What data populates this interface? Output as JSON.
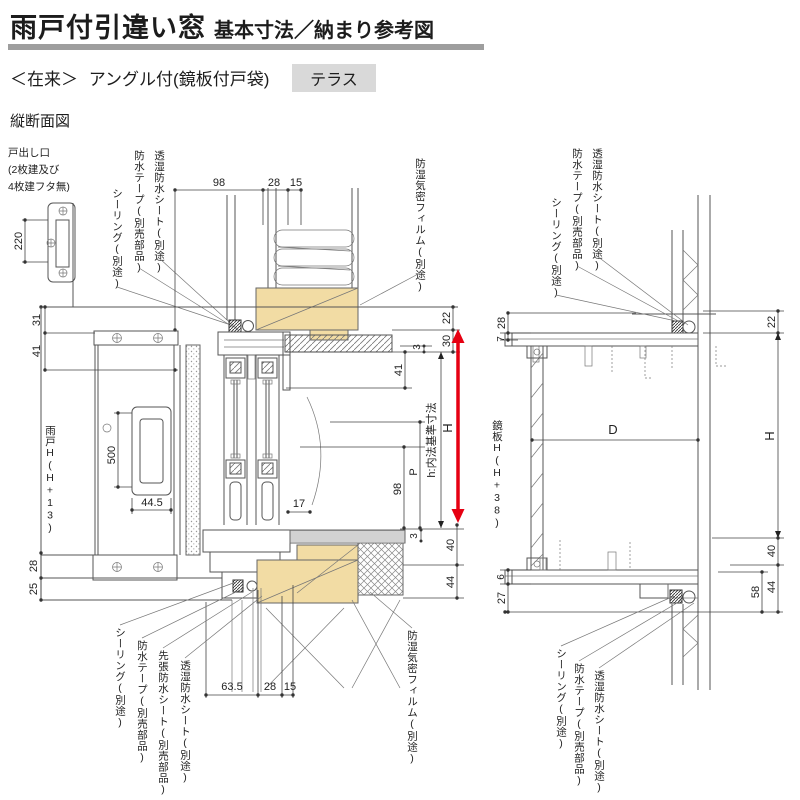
{
  "header": {
    "title_main": "雨戸付引違い窓",
    "title_sub": "基本寸法／納まり参考図",
    "tag_prefix": "＜在来＞",
    "tag_name": "アングル付(鏡板付戸袋)",
    "tag_badge": "テラス",
    "section": "縦断面図"
  },
  "note": {
    "l1": "戸出し口",
    "l2": "(2枚建及び",
    "l3": "4枚建フタ無)"
  },
  "labels": {
    "sealing": "シーリング(別途)",
    "tape": "防水テープ(別売部品)",
    "sheet": "透湿防水シート(別途)",
    "film": "防湿気密フィルム(別途)",
    "sakibari": "先張防水シート(別売部品)",
    "amado_h": "雨戸H(H+13)",
    "kagami_h": "鏡板H(H+38)",
    "h_inner": "h:内法基準寸法"
  },
  "dims_left": {
    "d220": "220",
    "d98": "98",
    "d28": "28",
    "d15": "15",
    "d31": "31",
    "d41": "41",
    "d22": "22",
    "d30": "30",
    "d3": "3",
    "d41r": "41",
    "dH": "H",
    "dP": "P",
    "d98r": "98",
    "d17": "17",
    "d500": "500",
    "d445": "44.5",
    "d3f": "3",
    "d40": "40",
    "d44": "44",
    "d28l": "28",
    "d25": "25",
    "d635": "63.5",
    "d28b": "28",
    "d15b": "15"
  },
  "dims_right": {
    "d28": "28",
    "d7": "7",
    "d22": "22",
    "dH": "H",
    "dD": "D",
    "d40": "40",
    "d58": "58",
    "d44": "44",
    "d6": "6",
    "d27": "27"
  },
  "colors": {
    "wood": "#f2dca4",
    "red_arrow": "#e60012",
    "badge_bg": "#d9d9d9",
    "title_bar": "#9e9e9e"
  }
}
